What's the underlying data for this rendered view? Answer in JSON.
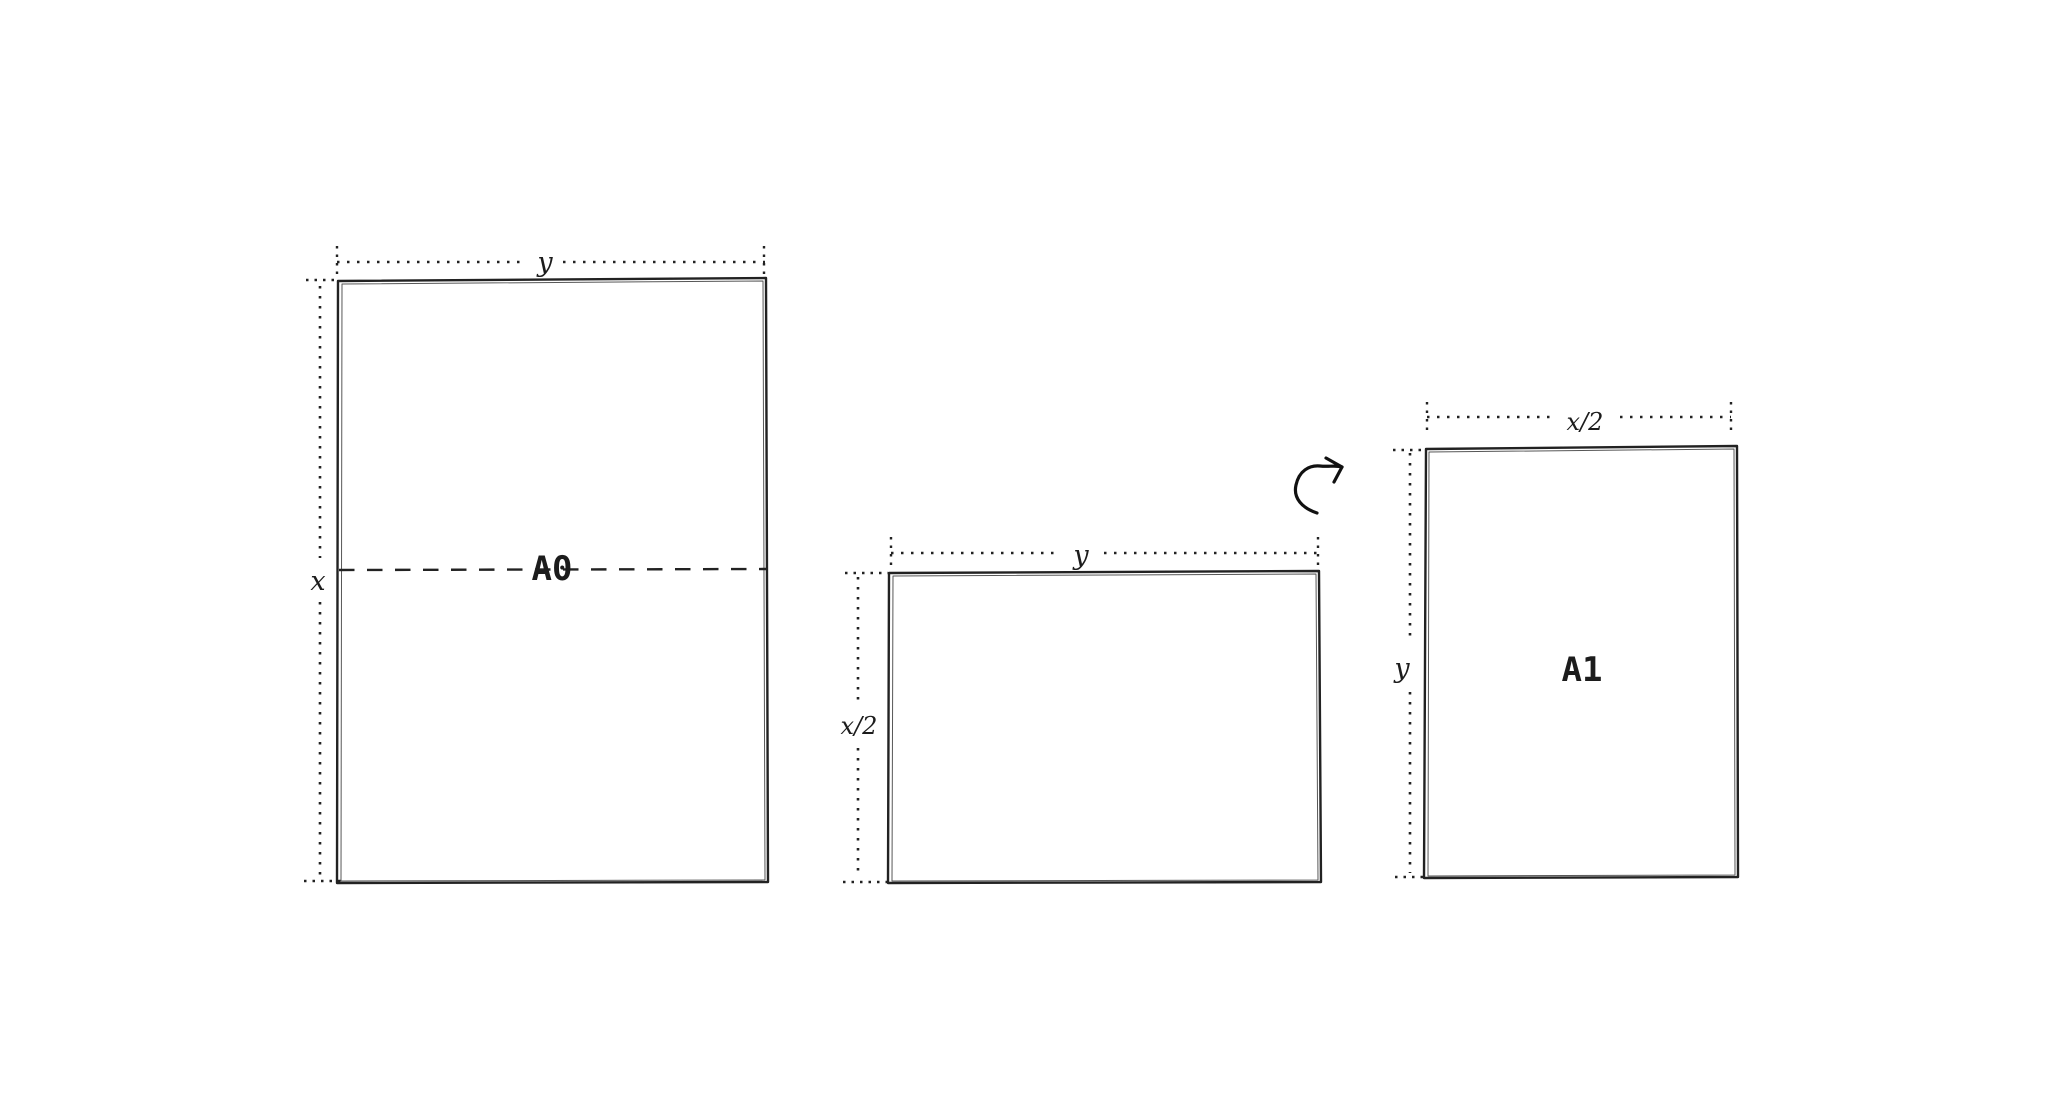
{
  "colors": {
    "background": "#ffffff",
    "ink": "#222222"
  },
  "sheets": {
    "a0": {
      "label": "A0",
      "width_dim_label": "y",
      "height_dim_label": "x"
    },
    "a1_landscape": {
      "width_dim_label": "y",
      "height_dim_label": "x/2"
    },
    "a1_portrait": {
      "label": "A1",
      "width_dim_label": "x/2",
      "height_dim_label": "y"
    }
  }
}
